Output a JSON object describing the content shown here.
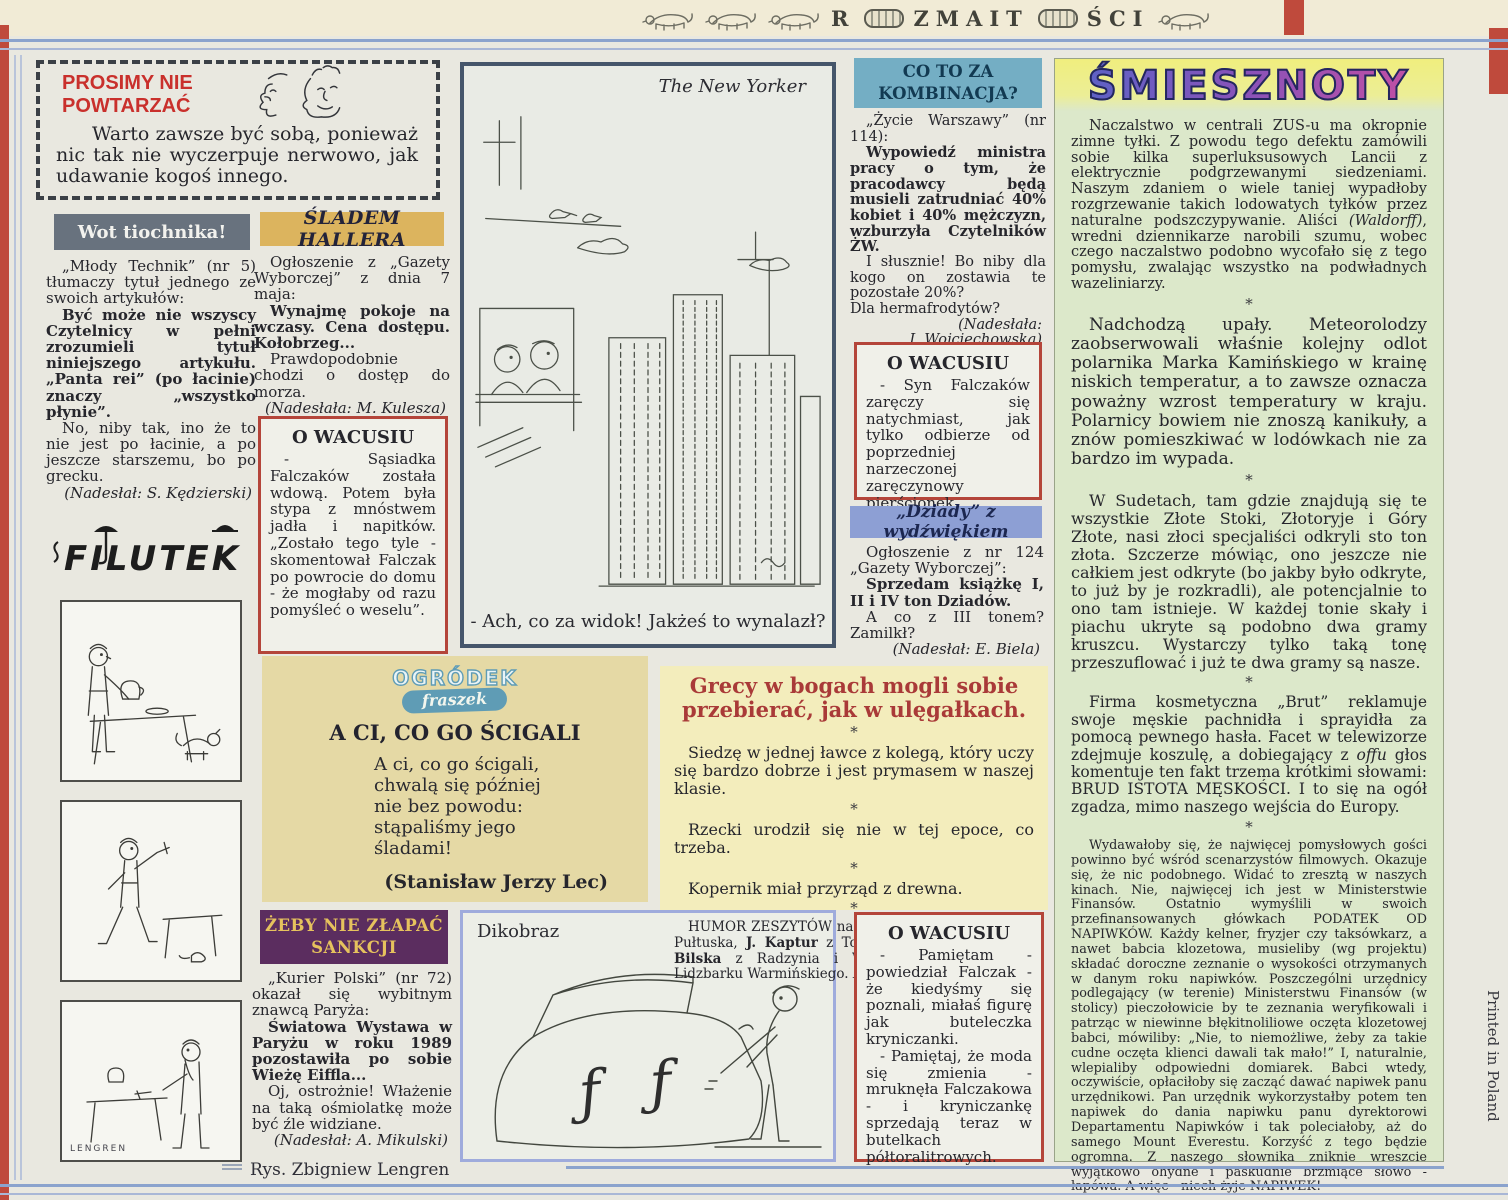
{
  "masthead": {
    "part1": "R",
    "part2": "ZMAIT",
    "part3": "ŚCI"
  },
  "glyphs": {
    "asterisk": "*"
  },
  "colors": {
    "accent_red": "#bf4a3c",
    "rule_blue": "#8ba3cd",
    "header_gray": "#68727e",
    "header_gold": "#dcb45e",
    "header_blue": "#74aec4",
    "header_periwinkle": "#8d9fd4",
    "header_purple": "#5b2d5f",
    "smiesznoty_green": "#dce8ca",
    "box_red": "#b4453a",
    "grecy_yellow": "#f3edbc",
    "ogrodek_tan": "#e5d9a5"
  },
  "prosimy": {
    "title": "PROSIMY NIE\nPOWTARZAĆ",
    "body": "Warto zawsze być sobą, ponieważ nic tak nie wyczerpuje nerwowo, jak udawanie kogoś innego."
  },
  "wot": {
    "header": "Wot tiochnika!",
    "p1": "„Młody Technik” (nr 5) tłumaczy tytuł jednego ze swoich artykułów:",
    "p2": "Być może nie wszyscy Czytelnicy w pełni zrozumieli tytuł niniejszego artykułu. „Panta rei” (po łacinie) znaczy „wszystko płynie”.",
    "p3": "No, niby tak, ino że to nie jest po łacinie, a po jeszcze starszemu, bo po grecku.",
    "credit": "(Nadesłał: S. Kędzierski)"
  },
  "filutek": {
    "logo": "FILUTEK",
    "signature": "LENGREN"
  },
  "rys_caption": "Rys. Zbigniew Lengren",
  "printed": "Printed in Poland",
  "sladem": {
    "header": "ŚLADEM HALLERA",
    "p1": "Ogłoszenie z „Gazety Wyborczej” z dnia 7 maja:",
    "p2": "Wynajmę pokoje na wczasy. Cena dostępu. Kołobrzeg...",
    "p3": "Prawdopodobnie chodzi o dostęp do morza.",
    "credit": "(Nadesłała: M. Kulesza)"
  },
  "wacusiu1": {
    "title": "O WACUSIU",
    "body": "- Sąsiadka Falczaków została wdową. Potem była stypa z mnóstwem jadła i napitków. „Zostało tego tyle - skomentował Falczak po powrocie do domu - że mogłaby od razu pomyśleć o weselu”."
  },
  "ogrodek": {
    "logo_line1": "OGRÓDEK",
    "logo_line2": "fraszek",
    "title": "A CI, CO GO ŚCIGALI",
    "poem": "A ci, co go ścigali,\nchwalą się później\nnie bez powodu:\nstąpaliśmy jego\nśladami!",
    "credit": "(Stanisław Jerzy Lec)"
  },
  "zeby": {
    "header": "ŻEBY NIE ZŁAPAĆ\nSANKCJI",
    "p1": "„Kurier Polski” (nr 72) okazał się wybitnym znawcą Paryża:",
    "p2": "Światowa Wystawa w Paryżu w roku 1989 pozostawiła po sobie Wieżę Eiffla...",
    "p3": "Oj, ostrożnie! Włażenie na taką ośmiolatkę może być źle widziane.",
    "credit": "(Nadesłał: A. Mikulski)"
  },
  "newyorker": {
    "label": "The New Yorker",
    "caption": "- Ach, co za widok! Jakżeś to wynalazł?"
  },
  "dikobraz": {
    "label": "Dikobraz"
  },
  "coto": {
    "header": "CO TO ZA\nKOMBINACJA?",
    "p1": "„Życie Warszawy” (nr 114):",
    "p2": "Wypowiedź ministra pracy o tym, że pracodawcy będą musieli zatrudniać 40% kobiet i 40% mężczyzn, wzburzyła Czytelników ŻW.",
    "p3": "I słusznie! Bo niby dla kogo on zostawia te pozostałe 20%?",
    "p4": "Dla hermafrodytów?",
    "credit": "(Nadesłała:\nI. Wojciechowska)"
  },
  "wacusiu2": {
    "title": "O WACUSIU",
    "body": "- Syn Falczaków zaręczy się natychmiast, jak tylko odbierze od poprzedniej narzeczonej zaręczynowy pierścionek."
  },
  "dziady": {
    "header": "„Dziady” z wydźwiękiem",
    "p1": "Ogłoszenie z nr 124 „Gazety Wyborczej”:",
    "p2": "Sprzedam książkę I, II i IV ton Dziadów.",
    "p3": "A co z III tonem? Zamilkł?",
    "credit": "(Nadesłał: E. Biela)"
  },
  "grecy": {
    "title": "Grecy w bogach mogli sobie przebierać, jak w ulęgałkach.",
    "items": [
      "Siedzę w jednej ławce z kolegą, który uczy się bardzo dobrze i jest prymasem w naszej klasie.",
      "Rzecki urodził się nie w tej epoce, co trzeba.",
      "Kopernik miał przyrząd z drewna."
    ],
    "footer_parts": [
      {
        "t": "HUMOR ZESZYTÓW nadesłali: ",
        "s": "n"
      },
      {
        "t": "A. Kozarzewski",
        "s": "b"
      },
      {
        "t": " z Pułtuska, ",
        "s": "n"
      },
      {
        "t": "J. Kaptur",
        "s": "b"
      },
      {
        "t": " z Tomaszowa Lubelskiego, ",
        "s": "n"
      },
      {
        "t": "J. Bilska",
        "s": "b"
      },
      {
        "t": " z Radzynia i ",
        "s": "n"
      },
      {
        "t": "W. Czermak-Nowina",
        "s": "b"
      },
      {
        "t": " z Lidzbarku Warmińskiego. ",
        "s": "n"
      },
      {
        "t": "Dziękujemy.",
        "s": "i"
      }
    ]
  },
  "wacusiu3": {
    "title": "O WACUSIU",
    "p1": "- Pamiętam - powiedział Falczak - że kiedyśmy się poznali, miałaś figurę jak buteleczka kryniczanki.",
    "p2": "- Pamiętaj, że moda się zmienia - mruknęła Falczakowa - i kryniczankę sprzedają teraz w butelkach półtoralitrowych."
  },
  "smiesznoty": {
    "header": "ŚMIESZNOTY",
    "p1_parts": [
      {
        "t": "Naczalstwo w centrali ZUS-u ma okropnie zimne tyłki. Z powodu tego defektu zamówili sobie kilka superluksusowych Lancii z elektrycznie podgrzewanymi siedzeniami. Naszym zdaniem o wiele taniej wypadłoby rozgrzewanie takich lodowatych tyłków przez naturalne podszczypywanie. Aliści ",
        "s": "n"
      },
      {
        "t": "(Waldorff)",
        "s": "i"
      },
      {
        "t": ", wredni dziennikarze narobili szumu, wobec czego naczalstwo podobno wycofało się z tego pomysłu, zwalając wszystko na podwładnych wazeliniarzy.",
        "s": "n"
      }
    ],
    "p2": "Nadchodzą upały. Meteorolodzy zaobserwowali właśnie kolejny odlot polarnika Marka Kamińskiego w krainę niskich temperatur, a to zawsze oznacza poważny wzrost temperatury w kraju. Polarnicy bowiem nie znoszą kanikuły, a znów pomieszkiwać w lodówkach nie za bardzo im wypada.",
    "p3": "W Sudetach, tam gdzie znajdują się te wszystkie Złote Stoki, Złotoryje i Góry Złote, nasi złoci specjaliści odkryli sto ton złota. Szczerze mówiąc, ono jeszcze nie całkiem jest odkryte (bo jakby było odkryte, to już by je rozkradli), ale potencjalnie to ono tam istnieje. W każdej tonie skały i piachu ukryte są podobno dwa gramy kruszcu. Wystarczy tylko taką tonę przeszuflować i już te dwa gramy są nasze.",
    "p4_parts": [
      {
        "t": "Firma kosmetyczna „Brut” reklamuje swoje męskie pachnidła i sprayidła za pomocą pewnego hasła. Facet w telewizorze zdejmuje koszulę, a dobiegający z ",
        "s": "n"
      },
      {
        "t": "offu",
        "s": "i"
      },
      {
        "t": " głos komentuje ten fakt trzema krótkimi słowami: BRUD ISTOTA MĘSKOŚCI. I to się na ogół zgadza, mimo naszego wejścia do Europy.",
        "s": "n"
      }
    ],
    "p5": "Wydawałoby się, że najwięcej pomysłowych gości powinno być wśród scenarzystów filmowych. Okazuje się, że nic podobnego. Widać to zresztą w naszych kinach. Nie, najwięcej ich jest w Ministerstwie Finansów. Ostatnio wymyślili w swoich przefinansowanych główkach PODATEK OD NAPIWKÓW. Każdy kelner, fryzjer czy taksówkarz, a nawet babcia klozetowa, musieliby (wg projektu) składać doroczne zeznanie o wysokości otrzymanych w danym roku napiwków. Poszczególni urzędnicy podlegający (w terenie) Ministerstwu Finansów (w stolicy) pieczołowicie by te zeznania weryfikowali i patrząc w niewinne błękitnoliliowe oczęta klozetowej babci, mówiliby: „Nie, to niemożliwe, żeby za takie cudne oczęta klienci dawali tak mało!” I, naturalnie, wlepialiby odpowiedni domiarek. Babci wtedy, oczywiście, opłaciłoby się zacząć dawać napiwek panu urzędnikowi. Pan urzędnik wykorzystałby potem ten napiwek do dania napiwku panu dyrektorowi Departamentu Napiwków i tak poleciałoby, aż do samego Mount Everestu. Korzyść z tego będzie ogromna. Z naszego słownika zniknie wreszcie wyjątkowo ohydne i paskudnie brzmiące słowo - łapówa. A więc - niech żyje NAPIWEK!",
    "signature": "Brat PRZEK-ROJEK"
  }
}
